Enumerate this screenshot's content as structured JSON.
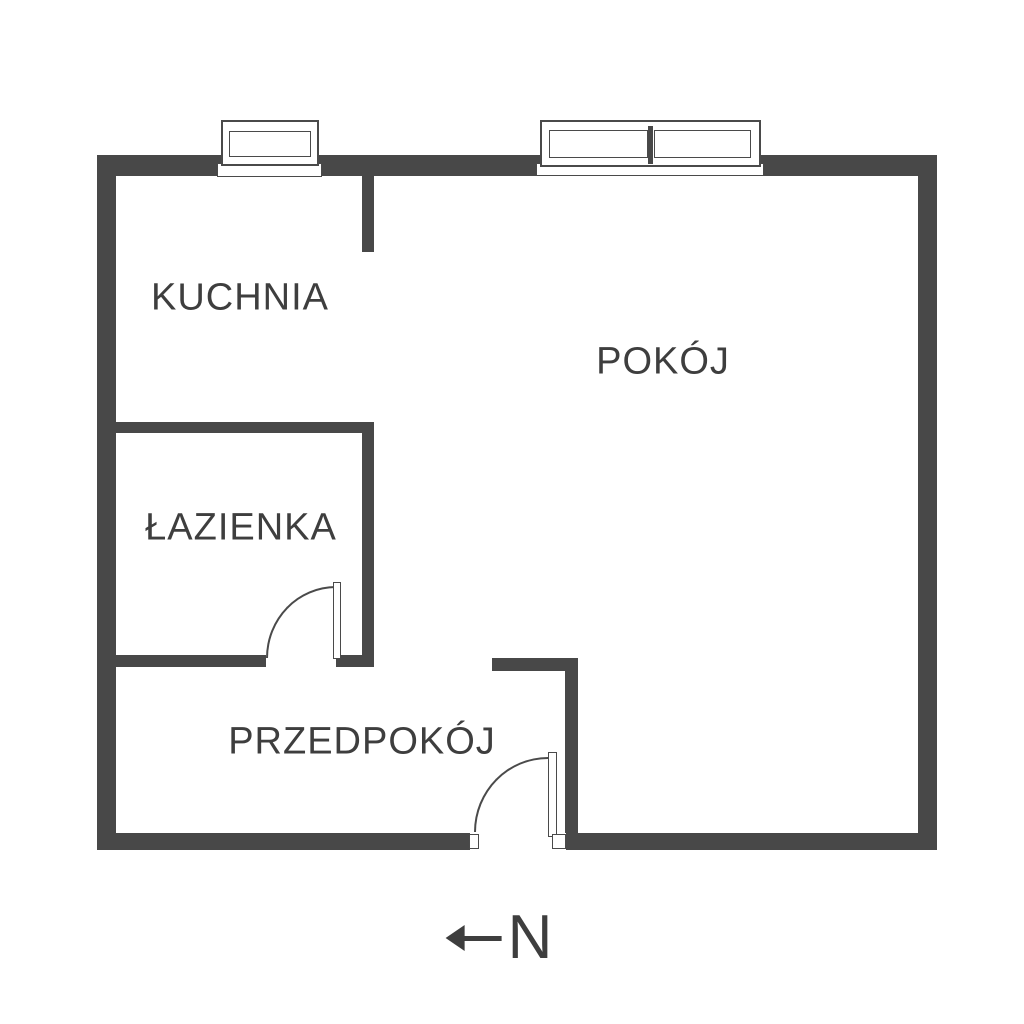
{
  "theme": {
    "wall": "#484848",
    "line": "#4a4a4a",
    "text": "#3e3e3e",
    "bg": "#ffffff"
  },
  "rooms": [
    {
      "id": "kuchnia",
      "label": "KUCHNIA"
    },
    {
      "id": "pokoj",
      "label": "POKÓJ"
    },
    {
      "id": "lazienka",
      "label": "ŁAZIENKA"
    },
    {
      "id": "przedpokoj",
      "label": "PRZEDPOKÓJ"
    }
  ],
  "compass": {
    "letter": "N",
    "direction": "left"
  }
}
